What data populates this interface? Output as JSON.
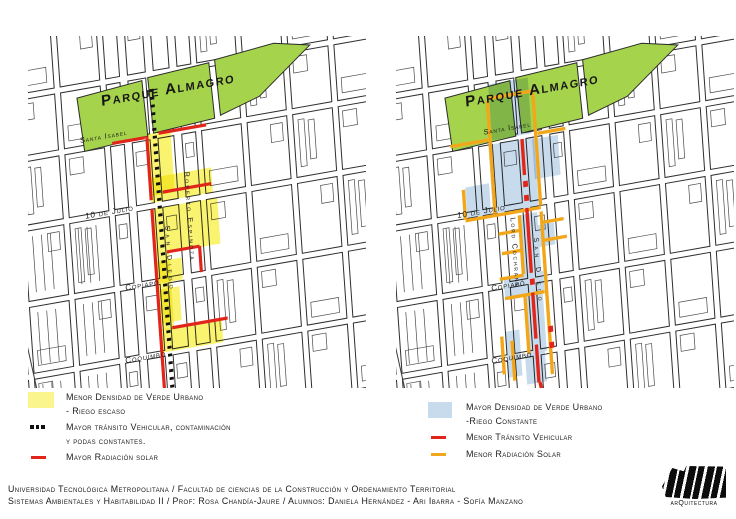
{
  "park_label": "Parque Almagro",
  "streets": {
    "santa_isabel": "Santa Isabel",
    "diez_de_julio": "10 de Julio",
    "copiapo": "Copiapó",
    "coquimbo": "Coquimbo",
    "roberto_espinoza": "Roberto Espinoza",
    "lord_cochrane": "Lord Cochrane",
    "san_diego": "San Diego"
  },
  "legend_left": {
    "items": [
      {
        "symbol": "yellow-area",
        "lines": [
          "Menor Densidad de Verde Urbano",
          "- Riego escaso"
        ]
      },
      {
        "symbol": "black-dots",
        "lines": [
          "Mayor tránsito Vehicular, contaminación",
          "y podas constantes."
        ]
      },
      {
        "symbol": "red-line",
        "lines": [
          "Mayor Radiación solar",
          ""
        ]
      }
    ]
  },
  "legend_right": {
    "items": [
      {
        "symbol": "blue-area",
        "lines": [
          "Mayor Densidad de Verde Urbano",
          "-Riego Constante"
        ]
      },
      {
        "symbol": "red-line",
        "lines": [
          "Menor Tránsito Vehicular",
          ""
        ]
      },
      {
        "symbol": "orange-line",
        "lines": [
          "Menor Radiación Solar",
          ""
        ]
      }
    ]
  },
  "footer": {
    "line1": "Universidad Tecnológica Metropolitana / Facultad de ciencias de la Construcción y Ordenamiento Territorial",
    "line2": "Sistemas Ambientales y Habitabilidad II / Prof: Rosa Chandía-Jaure / Alumnos: Daniela Hernández - Ari Ibarra - Sofía Manzano",
    "logo_text": "arQuitectura"
  },
  "colors": {
    "park_green": "#A6D34C",
    "low_density_yellow": "#F9F370",
    "high_density_blue": "#C8DBEC",
    "traffic_red": "#E1251B",
    "solar_orange": "#F2A71B",
    "ink": "#1F1F1F"
  }
}
